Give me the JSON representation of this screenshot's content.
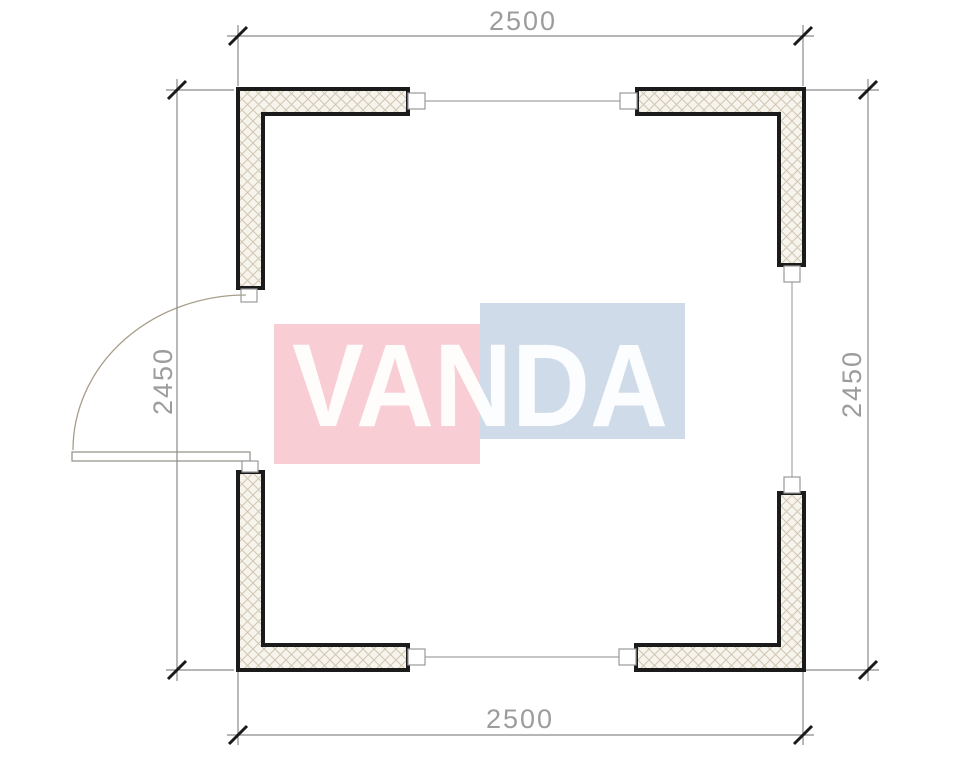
{
  "drawing": {
    "type": "floor-plan",
    "dimensions": {
      "top": "2500",
      "bottom": "2500",
      "left": "2450",
      "right": "2450"
    },
    "colors": {
      "wall_outline": "#1b1b1b",
      "wall_fill": "#f7f4ee",
      "hatch_line": "#d0c7b3",
      "window_line": "#a3a3a3",
      "connector_outline": "#9a9a9a",
      "dimension_line": "#8a8a8a",
      "dimension_tick": "#1a1a1a",
      "dimension_text": "#9c9c9c",
      "door_arc": "#a89f8a",
      "door_leaf_outline": "#8f8f85"
    }
  },
  "watermark": {
    "text": "VANDA",
    "pink_color": "#f8cdd4",
    "blue_color": "#cfdbe9",
    "text_color": "#ffffff"
  }
}
